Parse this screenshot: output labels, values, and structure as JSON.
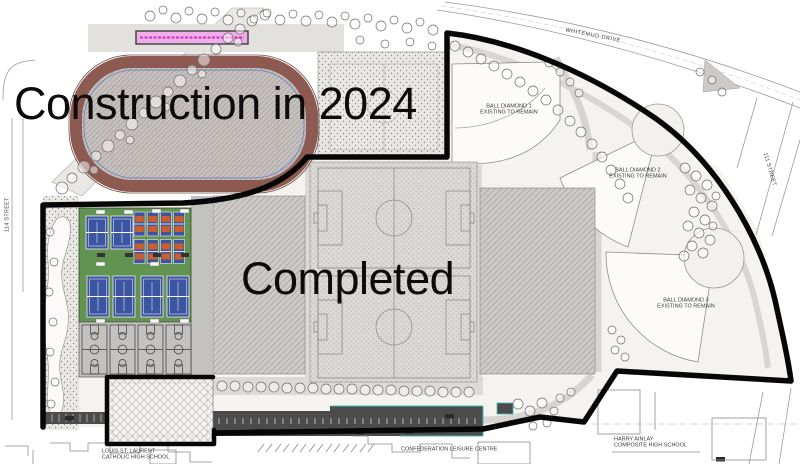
{
  "annotations": {
    "construction": "Construction in 2024",
    "completed": "Completed"
  },
  "streets": {
    "whitemud_drive": "WHITEMUD DRIVE",
    "street_111": "111 STREET",
    "street_114": "114 STREET"
  },
  "facilities": {
    "ball_diamond_1": {
      "l1": "BALL DIAMOND 1",
      "l2": "EXISTING TO REMAIN"
    },
    "ball_diamond_2": {
      "l1": "BALL DIAMOND 2",
      "l2": "EXISTING TO REMAIN"
    },
    "ball_diamond_3": {
      "l1": "BALL DIAMOND 3",
      "l2": "EXISTING TO REMAIN"
    }
  },
  "neighbors": {
    "louis_school": {
      "l1": "LOUIS ST. LAURENT",
      "l2": "CATHOLIC HIGH SCHOOL"
    },
    "leisure_centre": "CONFEDERATION LEISURE CENTRE",
    "harry_school": {
      "l1": "HARRY AINLAY",
      "l2": "COMPOSITE HIGH SCHOOL"
    }
  },
  "colors": {
    "track_brown": "#8d5a52",
    "court_green": "#639351",
    "court_blue": "#3c55a0",
    "pickleball_orange": "#cc5e2e",
    "bleacher_pink": "#efaee9",
    "parking_gray": "#4b4b4b",
    "teal_accent": "#49b8b2",
    "boundary_black": "#070707"
  }
}
